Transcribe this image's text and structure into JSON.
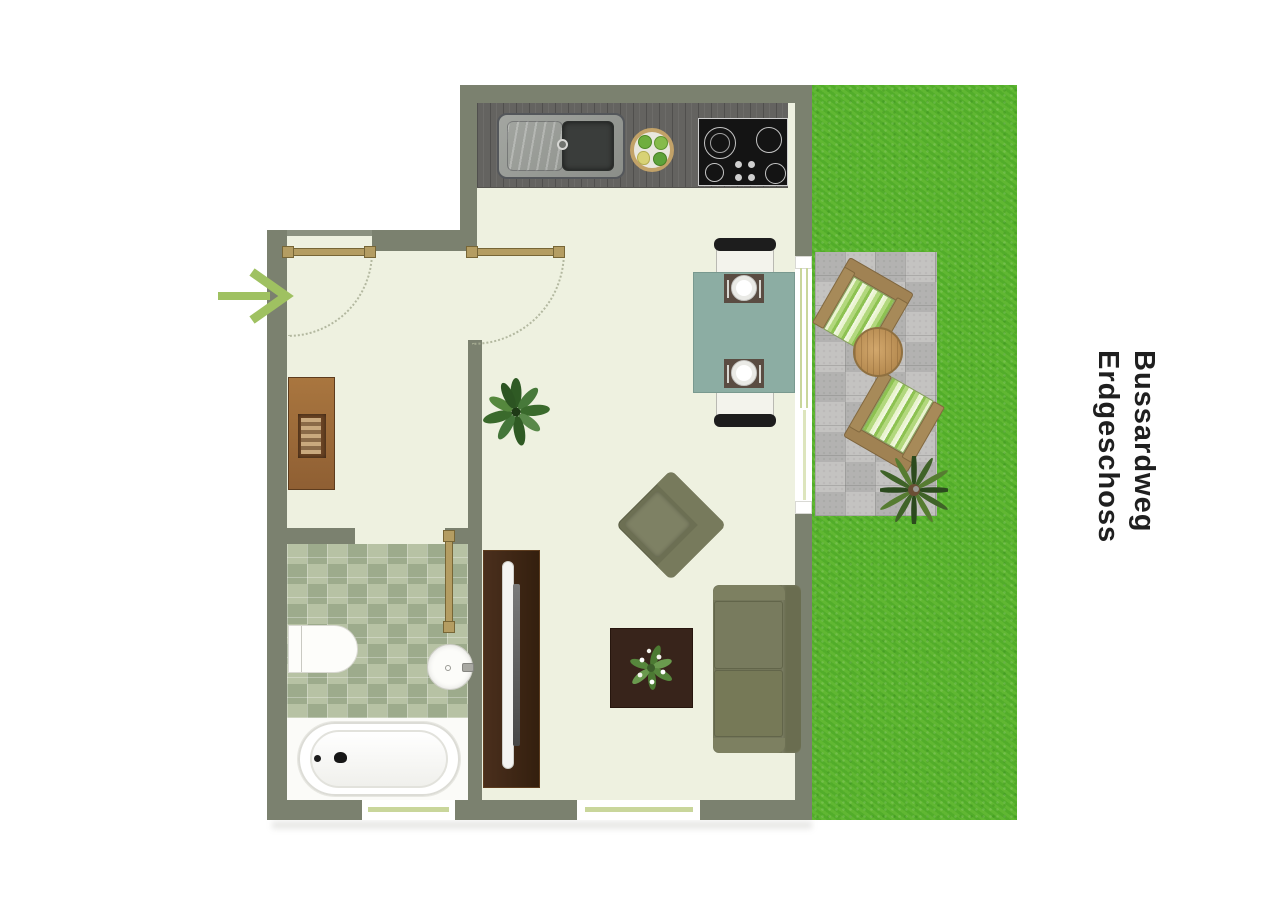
{
  "title": {
    "line1": "Bussardweg",
    "line2": "Erdgeschoss"
  },
  "plan": {
    "rooms": [
      "entrance-hall",
      "bathroom",
      "open-living-kitchen",
      "terrace",
      "garden"
    ],
    "fixtures": [
      "kitchen-counter",
      "kitchen-sink",
      "cooktop",
      "fruit-bowl",
      "dining-table",
      "dining-chair",
      "placemat-with-plate",
      "wardrobe",
      "potted-plant",
      "tv-sideboard",
      "tv",
      "armchair",
      "sofa",
      "coffee-table",
      "flower-arrangement",
      "toilet",
      "washbasin",
      "bathtub",
      "terrace-chair",
      "terrace-round-table",
      "palm-plant",
      "entrance-arrow",
      "door",
      "window",
      "terrace-sliding-door"
    ]
  },
  "colors": {
    "wall": "#7b816f",
    "floor": "#eef1e0",
    "grass": "#52ad2a",
    "paving": "#bdbcba",
    "bath_tiles": "#a9b698",
    "door_wood": "#b49d62",
    "dining_table": "#8cada3",
    "upholstery": "#73765a",
    "dark_wood": "#38241b",
    "arrow_green": "#9fc161"
  }
}
